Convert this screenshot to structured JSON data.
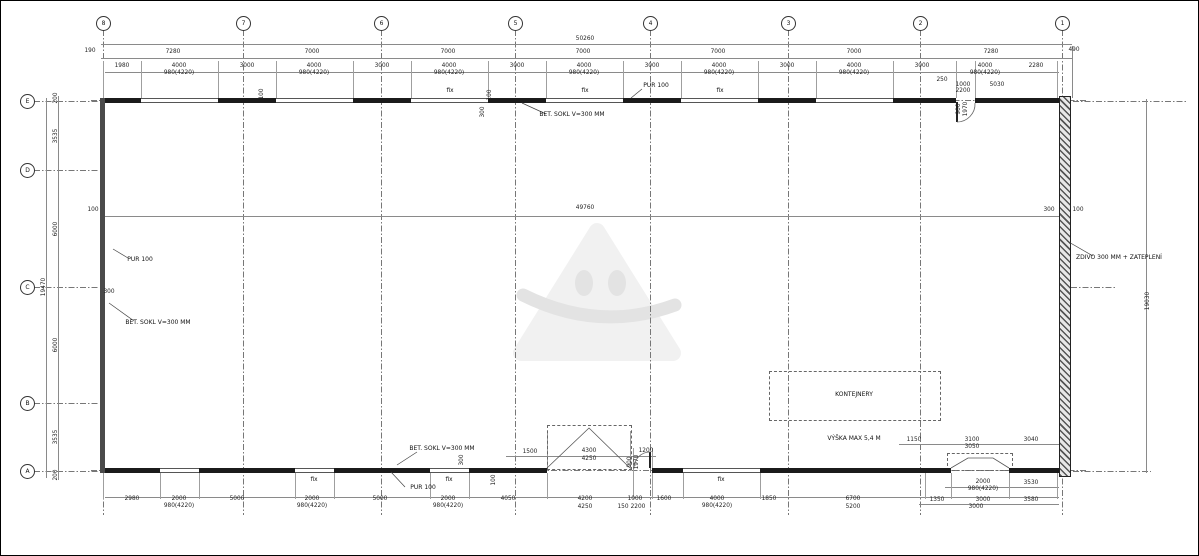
{
  "drawing": {
    "type": "floor-plan",
    "overall_width_label": "50260",
    "overall_interior_label": "49760",
    "overall_left_height_label": "19470",
    "overall_right_height_label": "19030"
  },
  "grid": {
    "columns": [
      [
        "8",
        102
      ],
      [
        "7",
        242
      ],
      [
        "6",
        380
      ],
      [
        "5",
        514
      ],
      [
        "4",
        649
      ],
      [
        "3",
        787
      ],
      [
        "2",
        919
      ],
      [
        "1",
        1061
      ]
    ],
    "rows": [
      [
        "E",
        100
      ],
      [
        "D",
        169
      ],
      [
        "C",
        286
      ],
      [
        "B",
        402
      ],
      [
        "A",
        470
      ]
    ]
  },
  "dimensions": [
    [
      "50260",
      584,
      39
    ],
    [
      "190",
      89,
      51
    ],
    [
      "7280",
      172,
      52
    ],
    [
      "7000",
      311,
      52
    ],
    [
      "7000",
      447,
      52
    ],
    [
      "7000",
      582,
      52
    ],
    [
      "7000",
      717,
      52
    ],
    [
      "7000",
      853,
      52
    ],
    [
      "7280",
      990,
      52
    ],
    [
      "490",
      1073,
      50
    ],
    [
      "1980",
      121,
      66
    ],
    [
      "4000",
      178,
      66
    ],
    [
      "3000",
      246,
      66
    ],
    [
      "4000",
      313,
      66
    ],
    [
      "3000",
      381,
      66
    ],
    [
      "4000",
      448,
      66
    ],
    [
      "3000",
      516,
      66
    ],
    [
      "4000",
      583,
      66
    ],
    [
      "3000",
      651,
      66
    ],
    [
      "4000",
      718,
      66
    ],
    [
      "3000",
      786,
      66
    ],
    [
      "4000",
      853,
      66
    ],
    [
      "3000",
      921,
      66
    ],
    [
      "4000",
      984,
      66
    ],
    [
      "2280",
      1035,
      66
    ],
    [
      "980(4220)",
      178,
      73
    ],
    [
      "980(4220)",
      313,
      73
    ],
    [
      "980(4220)",
      448,
      73
    ],
    [
      "980(4220)",
      583,
      73
    ],
    [
      "980(4220)",
      718,
      73
    ],
    [
      "980(4220)",
      853,
      73
    ],
    [
      "980(4220)",
      984,
      73
    ],
    [
      "250",
      941,
      80
    ],
    [
      "1000",
      962,
      85
    ],
    [
      "2200",
      962,
      91
    ],
    [
      "5030",
      996,
      85
    ],
    [
      "19470",
      44,
      286,
      1
    ],
    [
      "200",
      56,
      97,
      1
    ],
    [
      "3535",
      56,
      135,
      1
    ],
    [
      "6000",
      56,
      228,
      1
    ],
    [
      "6000",
      56,
      344,
      1
    ],
    [
      "3535",
      56,
      436,
      1
    ],
    [
      "200",
      56,
      474,
      1
    ],
    [
      "19030",
      1148,
      300,
      1
    ],
    [
      "49760",
      584,
      208
    ],
    [
      "100",
      92,
      210
    ],
    [
      "300",
      1048,
      210
    ],
    [
      "100",
      1077,
      210
    ],
    [
      "100",
      262,
      93,
      1
    ],
    [
      "100",
      490,
      94,
      1
    ],
    [
      "300",
      483,
      111,
      1
    ],
    [
      "300",
      108,
      292
    ],
    [
      "300",
      462,
      459,
      1
    ],
    [
      "100",
      494,
      479,
      1
    ],
    [
      "1500",
      529,
      452
    ],
    [
      "4300",
      588,
      451
    ],
    [
      "4250",
      588,
      459
    ],
    [
      "1200",
      645,
      451
    ],
    [
      "900",
      630,
      461,
      1
    ],
    [
      "1970",
      637,
      461,
      1
    ],
    [
      "900",
      959,
      108,
      1
    ],
    [
      "1970",
      966,
      108,
      1
    ],
    [
      "1150",
      913,
      440
    ],
    [
      "3100",
      971,
      440
    ],
    [
      "3050",
      971,
      447
    ],
    [
      "3040",
      1030,
      440
    ],
    [
      "2000",
      982,
      482
    ],
    [
      "980(4220)",
      982,
      489
    ],
    [
      "3530",
      1030,
      483
    ],
    [
      "1350",
      936,
      500
    ],
    [
      "3000",
      982,
      500
    ],
    [
      "3000",
      975,
      507
    ],
    [
      "3580",
      1030,
      500
    ],
    [
      "2980",
      131,
      499
    ],
    [
      "2000",
      178,
      499
    ],
    [
      "5000",
      236,
      499
    ],
    [
      "2000",
      311,
      499
    ],
    [
      "5000",
      379,
      499
    ],
    [
      "2000",
      447,
      499
    ],
    [
      "4050",
      507,
      499
    ],
    [
      "4200",
      584,
      499
    ],
    [
      "4250",
      584,
      507
    ],
    [
      "150",
      622,
      507
    ],
    [
      "1000",
      634,
      499
    ],
    [
      "2200",
      637,
      507
    ],
    [
      "1600",
      663,
      499
    ],
    [
      "4000",
      716,
      499
    ],
    [
      "1850",
      768,
      499
    ],
    [
      "6700",
      852,
      499
    ],
    [
      "5200",
      852,
      507
    ],
    [
      "980(4220)",
      178,
      506
    ],
    [
      "980(4220)",
      311,
      506
    ],
    [
      "980(4220)",
      447,
      506
    ],
    [
      "980(4220)",
      716,
      506
    ]
  ],
  "annotations": [
    [
      "PUR 100",
      655,
      85
    ],
    [
      "BET. SOKL V=300 MM",
      571,
      114
    ],
    [
      "PUR 100",
      139,
      259
    ],
    [
      "BET. SOKL V=300 MM",
      157,
      322
    ],
    [
      "BET. SOKL V=300 MM",
      441,
      448
    ],
    [
      "PUR 100",
      422,
      487
    ],
    [
      "ZDIVO 300 MM + ZATEPLENÍ",
      1118,
      257
    ],
    [
      "KONTEJNERY",
      853,
      394
    ],
    [
      "VÝŠKA MAX 5,4 M",
      853,
      438
    ]
  ],
  "fix_labels": [
    [
      "fix",
      449,
      91
    ],
    [
      "fix",
      584,
      91
    ],
    [
      "fix",
      719,
      91
    ],
    [
      "fix",
      313,
      480
    ],
    [
      "fix",
      448,
      480
    ],
    [
      "fix",
      720,
      480
    ]
  ],
  "colors": {
    "line": "#777777",
    "wall": "#1b1b1b",
    "hatch": "#555555",
    "watermark": "#e3e3e3"
  }
}
